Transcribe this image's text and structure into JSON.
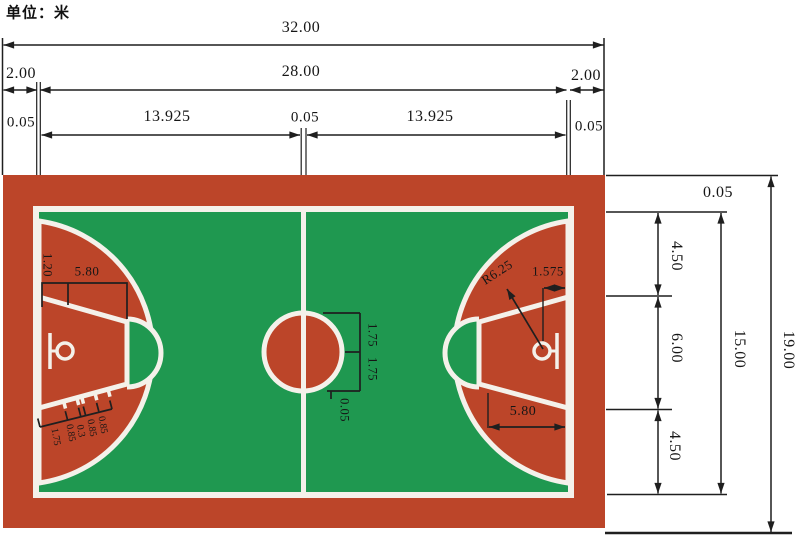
{
  "title": {
    "unit_label": "单位：米"
  },
  "colors": {
    "court_red": "#bc4529",
    "field_green": "#1f9850",
    "line_white": "#f4f1ea",
    "dim_black": "#1f1f1f"
  },
  "dimensions": {
    "total_length": "32.00",
    "court_length": "28.00",
    "margin_left": "2.00",
    "margin_right": "2.00",
    "sideline_width_left": "0.05",
    "half_court_left": "13.925",
    "center_line_width_top": "0.05",
    "half_court_right": "13.925",
    "sideline_width_right": "0.05",
    "endline_width": "0.05",
    "zone_top": "4.50",
    "lane_width": "6.00",
    "zone_bottom": "4.50",
    "court_width": "15.00",
    "total_width": "19.00"
  },
  "court_labels": {
    "backboard_offset": "1.20",
    "free_throw_distance_left": "5.80",
    "hash": [
      "1.75",
      "0.85",
      "0.3",
      "0.85",
      "0.85"
    ],
    "center_circle_radius_upper": "1.75",
    "center_circle_radius_lower": "1.75",
    "center_line_width": "0.05",
    "three_point_radius": "R6.25",
    "basket_to_endline": "1.575",
    "free_throw_distance_right": "5.80"
  }
}
